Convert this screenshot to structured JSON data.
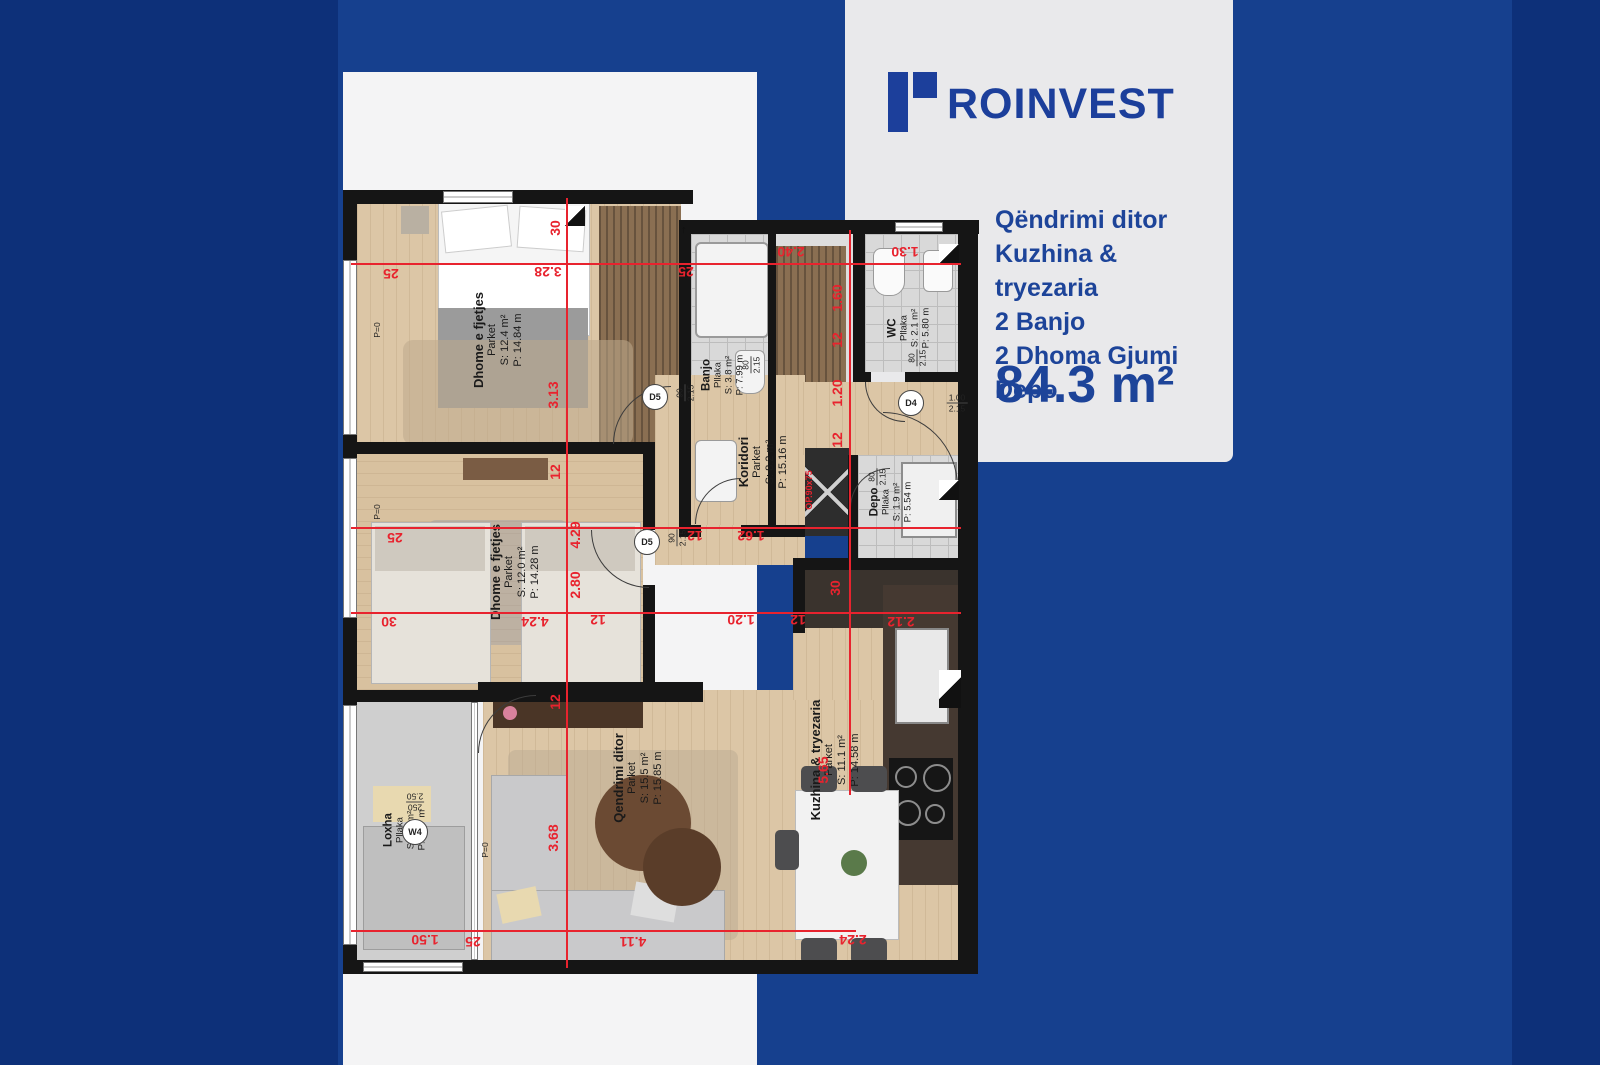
{
  "logo": {
    "word": "ROINVEST"
  },
  "panel": {
    "features": [
      "Qëndrimi ditor",
      "Kuzhina & tryezaria",
      "2 Banjo",
      "2 Dhoma Gjumi",
      "Depo"
    ],
    "area": "84.3 m²"
  },
  "plan": {
    "rooms": [
      {
        "name": "Dhome e fjetjes",
        "floor": "Parket",
        "s": "S: 12.4 m²",
        "p": "P: 14.84 m",
        "x": 155,
        "y": 150,
        "small": false
      },
      {
        "name": "Banjo",
        "floor": "Pllaka",
        "s": "S: 3.8 m²",
        "p": "P: 7.99 m",
        "x": 380,
        "y": 185,
        "small": true
      },
      {
        "name": "WC",
        "floor": "Pllaka",
        "s": "S: 2.1 m²",
        "p": "P: 5.80 m",
        "x": 566,
        "y": 138,
        "small": true
      },
      {
        "name": "Koridori",
        "flobor": "",
        "floor": "Parket",
        "s": "S: 8.2 m²",
        "p": "P: 15.16 m",
        "x": 420,
        "y": 272,
        "small": false
      },
      {
        "name": "Depo",
        "floor": "Pllaka",
        "s": "S: 1.9 m²",
        "p": "P: 5.54 m",
        "x": 548,
        "y": 312,
        "small": true
      },
      {
        "name": "Dhome e fjetjes",
        "floor": "Parket",
        "s": "S: 12.0 m²",
        "p": "P: 14.28 m",
        "x": 172,
        "y": 382,
        "small": false
      },
      {
        "name": "Qendrimi ditor",
        "floor": "Parket",
        "s": "S: 15.5 m²",
        "p": "P: 15.85 m",
        "x": 295,
        "y": 588,
        "small": false
      },
      {
        "name": "Kuzhina & tryezaria",
        "floor": "Parket",
        "s": "S: 11.1 m²",
        "p": "P: 14.58 m",
        "x": 492,
        "y": 570,
        "small": false
      },
      {
        "name": "Loxha",
        "floor": "Pllaka",
        "s": "S: 4.6 m²",
        "p": "P: 9.47 m",
        "x": 62,
        "y": 640,
        "small": true
      }
    ],
    "dims": [
      {
        "t": "25",
        "x": 48,
        "y": 84,
        "r": 180
      },
      {
        "t": "3.28",
        "x": 205,
        "y": 82,
        "r": 180
      },
      {
        "t": "25",
        "x": 343,
        "y": 82,
        "r": 180
      },
      {
        "t": "2.40",
        "x": 448,
        "y": 62,
        "r": 180
      },
      {
        "t": "1.30",
        "x": 562,
        "y": 62,
        "r": 180
      },
      {
        "t": "25",
        "x": 52,
        "y": 348,
        "r": 180
      },
      {
        "t": "12",
        "x": 352,
        "y": 346,
        "r": 180
      },
      {
        "t": "1.62",
        "x": 408,
        "y": 346,
        "r": 180
      },
      {
        "t": "30",
        "x": 46,
        "y": 432,
        "r": 180
      },
      {
        "t": "4.24",
        "x": 192,
        "y": 432,
        "r": 180
      },
      {
        "t": "12",
        "x": 255,
        "y": 430,
        "r": 180
      },
      {
        "t": "1.20",
        "x": 398,
        "y": 430,
        "r": 180
      },
      {
        "t": "12",
        "x": 455,
        "y": 430,
        "r": 180
      },
      {
        "t": "2.12",
        "x": 558,
        "y": 432,
        "r": 180
      },
      {
        "t": "1.50",
        "x": 82,
        "y": 750,
        "r": 180
      },
      {
        "t": "25",
        "x": 130,
        "y": 752,
        "r": 180
      },
      {
        "t": "4.11",
        "x": 290,
        "y": 752,
        "r": 180
      },
      {
        "t": "2.24",
        "x": 510,
        "y": 750,
        "r": 180
      },
      {
        "t": "30",
        "x": 212,
        "y": 38,
        "r": -90
      },
      {
        "t": "3.13",
        "x": 210,
        "y": 205,
        "r": -90
      },
      {
        "t": "12",
        "x": 212,
        "y": 282,
        "r": -90
      },
      {
        "t": "4.29",
        "x": 232,
        "y": 345,
        "r": -90
      },
      {
        "t": "2.80",
        "x": 232,
        "y": 395,
        "r": -90
      },
      {
        "t": "12",
        "x": 212,
        "y": 512,
        "r": -90
      },
      {
        "t": "3.68",
        "x": 210,
        "y": 648,
        "r": -90
      },
      {
        "t": "1.60",
        "x": 494,
        "y": 108,
        "r": -90
      },
      {
        "t": "12",
        "x": 494,
        "y": 150,
        "r": -90
      },
      {
        "t": "1.20",
        "x": 494,
        "y": 203,
        "r": -90
      },
      {
        "t": "12",
        "x": 494,
        "y": 250,
        "r": -90
      },
      {
        "t": "30",
        "x": 492,
        "y": 398,
        "r": -90
      },
      {
        "t": "5.65",
        "x": 480,
        "y": 580,
        "r": -90
      },
      {
        "t": "OP.90x75",
        "x": 466,
        "y": 300,
        "r": -90,
        "s": 9
      }
    ],
    "door_tags": [
      {
        "id": "D5",
        "top": "90",
        "bot": "2.15",
        "cx": 312,
        "cy": 207,
        "fx": 342,
        "fy": 203,
        "fr": -90
      },
      {
        "id": "D5",
        "top": "90",
        "bot": "2.15",
        "cx": 304,
        "cy": 352,
        "fx": 334,
        "fy": 348,
        "fr": -90
      },
      {
        "id": "D4",
        "top": "1.00",
        "bot": "2.15",
        "cx": 568,
        "cy": 213,
        "fx": 614,
        "fy": 213,
        "fr": 0
      },
      {
        "id": "W4",
        "top": "250",
        "bot": "2.50",
        "cx": 72,
        "cy": 642,
        "fx": 72,
        "fy": 612,
        "fr": 180
      }
    ],
    "size_tags": [
      {
        "top": "80",
        "bot": "2.15",
        "x": 408,
        "y": 175
      },
      {
        "top": "80",
        "bot": "2.15",
        "x": 574,
        "y": 168
      },
      {
        "top": "80",
        "bot": "2.15",
        "x": 534,
        "y": 287
      }
    ],
    "p0_tags": [
      {
        "t": "P=0",
        "x": 34,
        "y": 140
      },
      {
        "t": "P=0",
        "x": 34,
        "y": 322
      },
      {
        "t": "P=0",
        "x": 142,
        "y": 660
      }
    ]
  }
}
